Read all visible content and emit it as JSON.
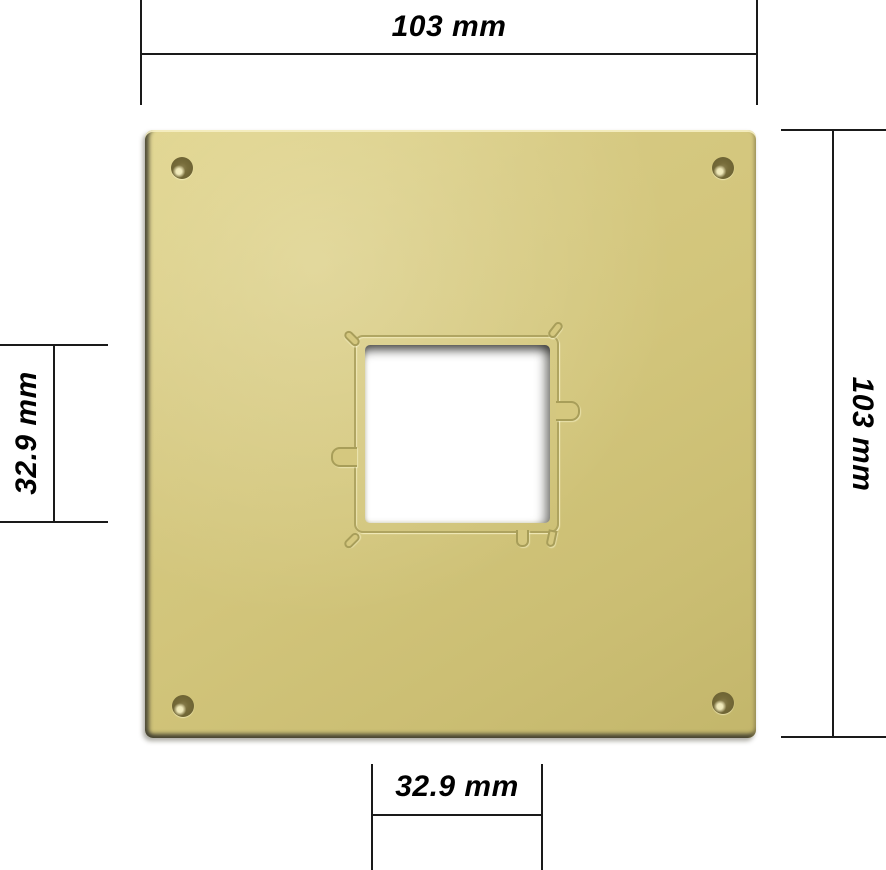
{
  "image": {
    "background_color": "#ffffff",
    "subject": "brass square mounting plate with central square cutout, four corner screw holes and dimension annotations"
  },
  "plate": {
    "color_main": "#d2c57b",
    "color_light": "#ded289",
    "color_dark": "#c3b66b",
    "edge_shadow_color": "#5d5b46",
    "engraving_color": "#b0a561",
    "cutout_fill": "#ffffff",
    "screw_hole_color": "#6e6434",
    "screw_holes": [
      "top-left",
      "top-right",
      "bottom-left",
      "bottom-right"
    ]
  },
  "dimensions": {
    "line_color": "#1a1a1a",
    "top": {
      "label": "103 mm"
    },
    "right": {
      "label": "103 mm"
    },
    "left": {
      "label": "32.9 mm"
    },
    "bottom": {
      "label": "32.9 mm"
    }
  }
}
